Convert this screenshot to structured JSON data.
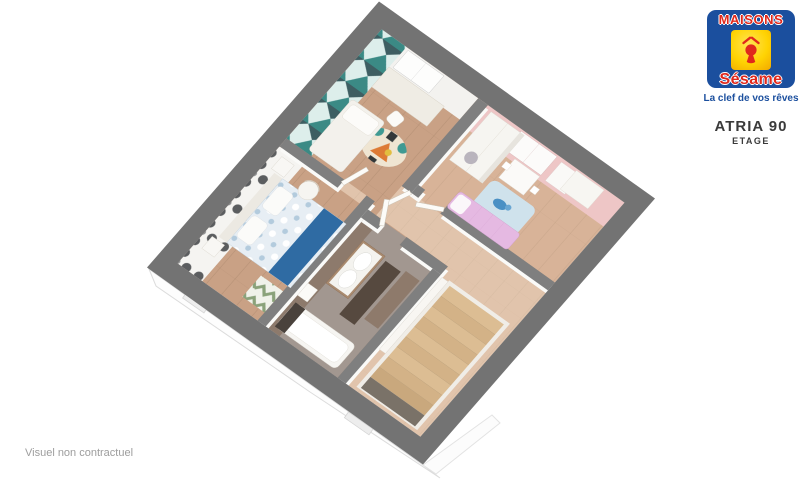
{
  "branding": {
    "logo_primary": "MAISONS",
    "logo_secondary": "Sésame",
    "tagline": "La clef de vos rêves",
    "logo_icon": "keyhole-house-icon",
    "colors": {
      "blue": "#1b4f9e",
      "red": "#e0281c",
      "yellow": "#ffd303"
    }
  },
  "plan_header": {
    "model": "ATRIA 90",
    "level": "ETAGE"
  },
  "footer": {
    "disclaimer": "Visuel non contractuel"
  },
  "render_palette": {
    "exterior_wall_gray": "#737373",
    "interior_wall_gray": "#7f7f7f",
    "wood_floor": "#c9a185",
    "hall_wood": "#dcc6ab",
    "bathroom_floor": "#a29790",
    "wallpaper_teal": "#3b8a85",
    "wallpaper_damask_motif": "#5b5d5f",
    "kids_wall_pink": "#eec6c6",
    "bed_runner_blue": "#2f6ba3",
    "kids_bed_pink": "#e5b9e2",
    "stair_wood": "#d9ba90"
  }
}
